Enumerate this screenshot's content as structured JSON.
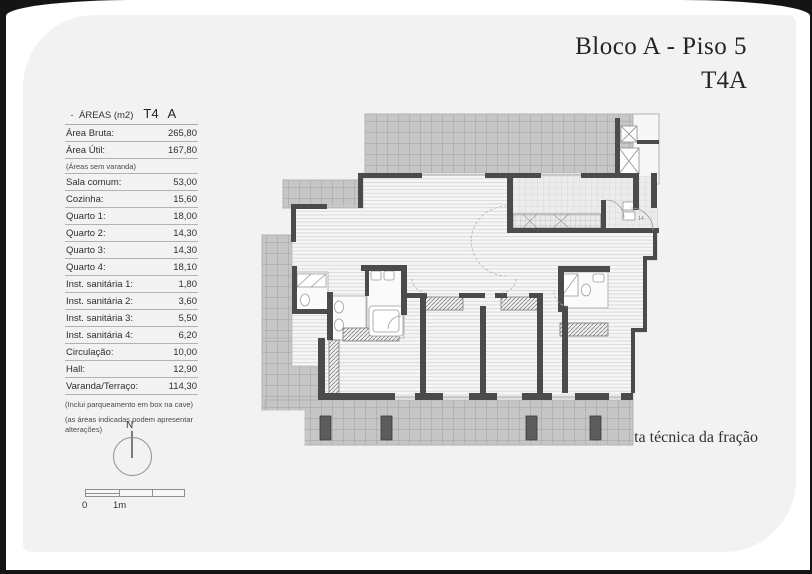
{
  "page": {
    "title_line1": "Bloco A - Piso 5",
    "title_line2": "T4A",
    "caption": "Planta técnica da fração"
  },
  "areas_table": {
    "header": {
      "bullet": "-",
      "label": "ÁREAS (m2)",
      "col1": "T4",
      "col2": "A"
    },
    "rows": [
      {
        "label": "Área Bruta:",
        "value": "265,80",
        "note": false
      },
      {
        "label": "Área Útil:",
        "value": "167,80",
        "note": false
      },
      {
        "label": "(Áreas sem varanda)",
        "value": "",
        "note": true
      },
      {
        "label": "Sala comum:",
        "value": "53,00",
        "note": false
      },
      {
        "label": "Cozinha:",
        "value": "15,60",
        "note": false
      },
      {
        "label": "Quarto 1:",
        "value": "18,00",
        "note": false
      },
      {
        "label": "Quarto 2:",
        "value": "14,30",
        "note": false
      },
      {
        "label": "Quarto 3:",
        "value": "14,30",
        "note": false
      },
      {
        "label": "Quarto 4:",
        "value": "18,10",
        "note": false
      },
      {
        "label": "Inst. sanitária 1:",
        "value": "1,80",
        "note": false
      },
      {
        "label": "Inst. sanitária 2:",
        "value": "3,60",
        "note": false
      },
      {
        "label": "Inst. sanitária 3:",
        "value": "5,50",
        "note": false
      },
      {
        "label": "Inst. sanitária 4:",
        "value": "6,20",
        "note": false
      },
      {
        "label": "Circulação:",
        "value": "10,00",
        "note": false
      },
      {
        "label": "Hall:",
        "value": "12,90",
        "note": false
      },
      {
        "label": "Varanda/Terraço:",
        "value": "114,30",
        "note": false
      }
    ],
    "footnotes": [
      "(Inclui parqueamento em box na cave)",
      "(as áreas indicadas podem apresentar alterações)"
    ]
  },
  "compass": {
    "label": "N"
  },
  "scalebar": {
    "zero_label": "0",
    "one_label": "1m"
  },
  "plan": {
    "door_label": "14"
  },
  "colors": {
    "page_bg": "#f2f2f2",
    "wall": "#4b4b4b",
    "terrace_fill": "#c6c6c6",
    "title_text": "#23232b"
  }
}
